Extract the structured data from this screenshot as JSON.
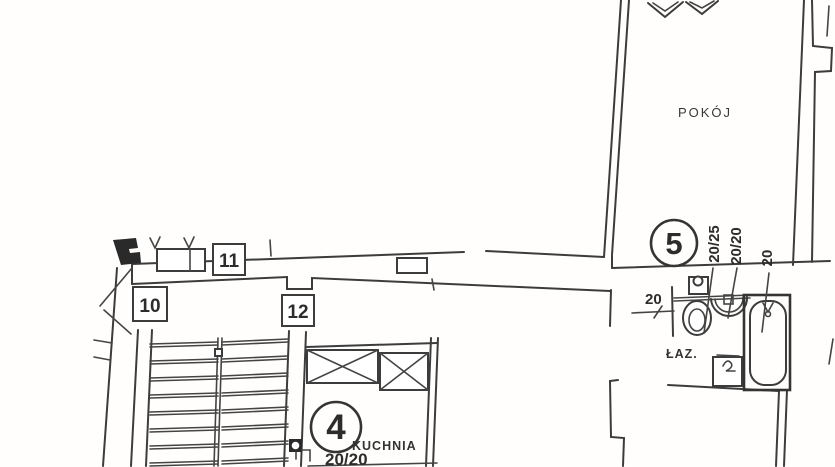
{
  "drawing": {
    "ink_color": "#3c3c3c",
    "paper_color": "#ffffff",
    "rooms": {
      "pokoj": "POKÓJ",
      "lazienka": "ŁAZ.",
      "kuchnia": "KUCHNIA"
    },
    "markers": {
      "box_10": "10",
      "box_11": "11",
      "box_12": "12",
      "circle_4": "4",
      "circle_5": "5"
    },
    "dimensions": {
      "bath_vert_1": "20/25",
      "bath_vert_2": "20/20",
      "bath_vert_3": "20",
      "bath_horiz": "20",
      "kitchen": "20/20"
    }
  }
}
